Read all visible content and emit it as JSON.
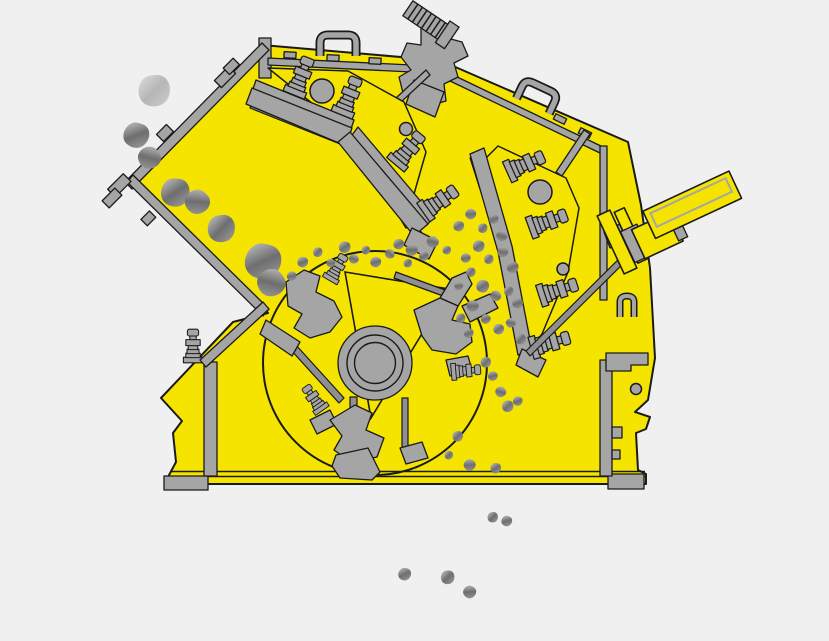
{
  "meta": {
    "subject": "impact-crusher-cross-section-diagram"
  },
  "colors": {
    "background": "#f0f0f0",
    "body_yellow": "#f5e400",
    "part_gray": "#a5a5a5",
    "part_gray_dark": "#8f8f8f",
    "outline": "#1a1a1a",
    "rock_light": "#c9c9c9",
    "rock_mid": "#6e6e6e",
    "rock_soft": "#a0a0a0"
  },
  "feed_rocks": [
    [
      155,
      90,
      1.5,
      0,
      0.45
    ],
    [
      137,
      135,
      1.2,
      25,
      1
    ],
    [
      150,
      158,
      1.05,
      60,
      1
    ],
    [
      176,
      192,
      1.35,
      10,
      1
    ],
    [
      198,
      202,
      1.15,
      50,
      1
    ],
    [
      222,
      228,
      1.3,
      0,
      1
    ],
    [
      264,
      261,
      1.7,
      20,
      1
    ],
    [
      272,
      283,
      1.3,
      60,
      1
    ]
  ],
  "chamber_particles": [
    [
      303,
      262,
      0.5,
      20
    ],
    [
      318,
      252,
      0.45,
      0
    ],
    [
      331,
      263,
      0.4,
      45
    ],
    [
      345,
      247,
      0.55,
      10
    ],
    [
      354,
      259,
      0.45,
      60
    ],
    [
      366,
      250,
      0.4,
      0
    ],
    [
      376,
      262,
      0.5,
      30
    ],
    [
      390,
      254,
      0.45,
      80
    ],
    [
      399,
      244,
      0.5,
      15
    ],
    [
      412,
      250,
      0.55,
      45
    ],
    [
      408,
      263,
      0.4,
      0
    ],
    [
      424,
      256,
      0.45,
      20
    ],
    [
      433,
      242,
      0.55,
      60
    ],
    [
      447,
      250,
      0.4,
      10
    ],
    [
      292,
      276,
      0.45,
      30
    ],
    [
      459,
      226,
      0.5,
      15
    ],
    [
      471,
      214,
      0.5,
      40
    ],
    [
      483,
      228,
      0.45,
      0
    ],
    [
      494,
      219,
      0.45,
      25
    ],
    [
      502,
      236,
      0.5,
      60
    ],
    [
      479,
      246,
      0.55,
      10
    ],
    [
      466,
      258,
      0.45,
      35
    ],
    [
      489,
      259,
      0.45,
      0
    ],
    [
      503,
      252,
      0.5,
      50
    ],
    [
      513,
      267,
      0.55,
      20
    ],
    [
      471,
      272,
      0.45,
      0
    ],
    [
      459,
      286,
      0.4,
      40
    ],
    [
      483,
      286,
      0.6,
      15
    ],
    [
      496,
      296,
      0.5,
      70
    ],
    [
      509,
      291,
      0.45,
      0
    ],
    [
      518,
      303,
      0.5,
      25
    ],
    [
      473,
      306,
      0.55,
      45
    ],
    [
      461,
      318,
      0.45,
      0
    ],
    [
      486,
      319,
      0.45,
      30
    ],
    [
      499,
      329,
      0.5,
      10
    ],
    [
      511,
      323,
      0.45,
      55
    ],
    [
      521,
      339,
      0.5,
      0
    ],
    [
      469,
      333,
      0.45,
      20
    ],
    [
      486,
      362,
      0.5,
      0
    ],
    [
      493,
      376,
      0.45,
      30
    ],
    [
      501,
      392,
      0.5,
      60
    ],
    [
      508,
      406,
      0.55,
      0
    ],
    [
      518,
      401,
      0.45,
      25
    ],
    [
      458,
      436,
      0.5,
      0
    ],
    [
      470,
      465,
      0.55,
      40
    ],
    [
      496,
      468,
      0.5,
      10
    ],
    [
      449,
      455,
      0.4,
      0
    ]
  ],
  "discharge_particles": [
    [
      405,
      574,
      0.6,
      20
    ],
    [
      448,
      577,
      0.65,
      0
    ],
    [
      470,
      592,
      0.6,
      40
    ],
    [
      493,
      517,
      0.5,
      0
    ],
    [
      507,
      521,
      0.5,
      30
    ]
  ]
}
